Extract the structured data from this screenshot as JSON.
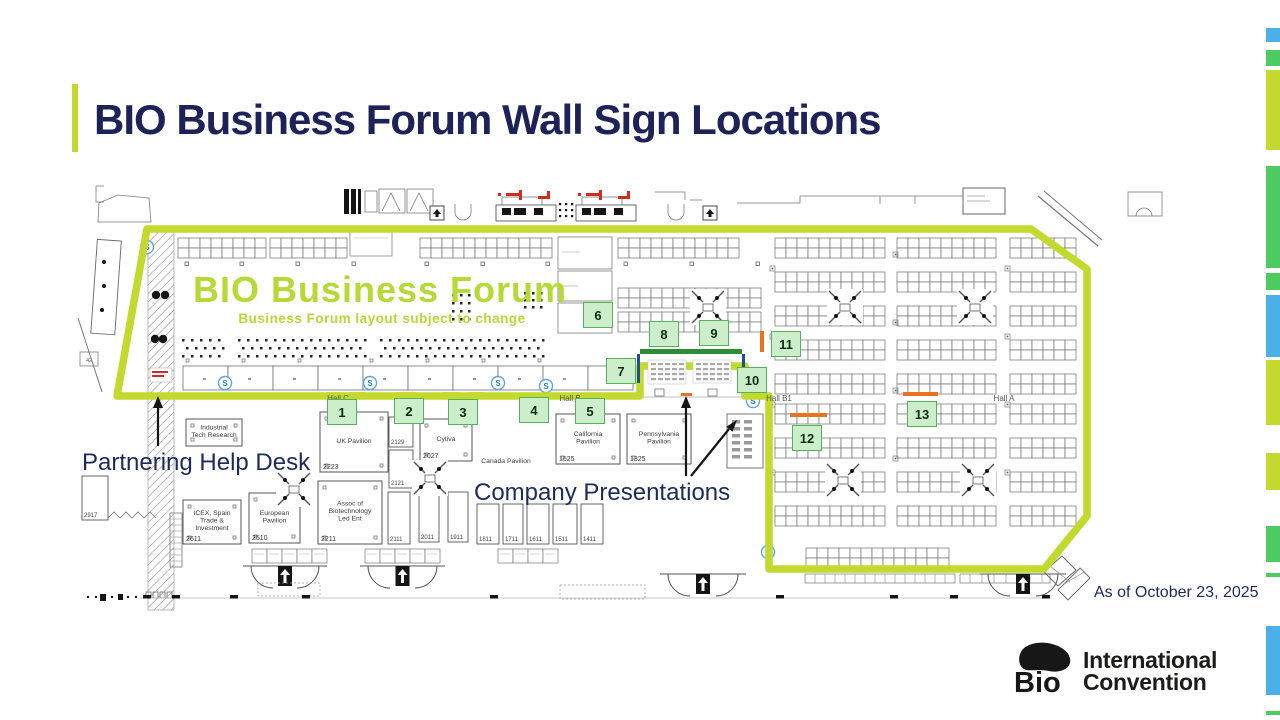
{
  "slide": {
    "title": "BIO Business Forum Wall Sign Locations",
    "as_of": "As of October 23, 2025"
  },
  "colors": {
    "chartreuse": "#c3d92d",
    "green": "#4dcb60",
    "blue": "#4cb0e8",
    "navy": "#1d2358",
    "label_navy": "#1d2a5e",
    "badge_fill": "#cdeeca",
    "badge_border": "#55b25b",
    "orange": "#e8721f",
    "red": "#d42a20",
    "yellow": "#e6e63c",
    "stage_green": "#2e8b36",
    "stage_blue": "#1d4f96",
    "forum_text": "#b5d935",
    "map_line": "#7a7a7a",
    "map_dark": "#141414"
  },
  "edge_bars": [
    {
      "color": "blue",
      "y": 28,
      "h": 14
    },
    {
      "color": "green",
      "y": 50,
      "h": 16
    },
    {
      "color": "chartreuse",
      "y": 70,
      "h": 80
    },
    {
      "color": "green",
      "y": 166,
      "h": 102
    },
    {
      "color": "green",
      "y": 273,
      "h": 17
    },
    {
      "color": "blue",
      "y": 295,
      "h": 62
    },
    {
      "color": "chartreuse",
      "y": 360,
      "h": 65
    },
    {
      "color": "chartreuse",
      "y": 453,
      "h": 37
    },
    {
      "color": "green",
      "y": 526,
      "h": 36
    },
    {
      "color": "green",
      "y": 573,
      "h": 4
    },
    {
      "color": "blue",
      "y": 626,
      "h": 69
    },
    {
      "color": "green",
      "y": 711,
      "h": 4
    }
  ],
  "floor_plan": {
    "forum_title": "BIO Business Forum",
    "forum_subtitle": "Business Forum layout subject to change",
    "s_marker": "S",
    "halls": [
      {
        "label": "Hall C",
        "x": 338,
        "y": 401
      },
      {
        "label": "Hall B",
        "x": 570,
        "y": 401
      },
      {
        "label": "Hall B1",
        "x": 779,
        "y": 401
      },
      {
        "label": "Hall A",
        "x": 1004,
        "y": 401
      }
    ],
    "pavilions": [
      {
        "name": "Industrial\nTech Research",
        "booth": "",
        "x": 186,
        "y": 419,
        "w": 56,
        "h": 27
      },
      {
        "name": "UK Pavilion",
        "booth": "2223",
        "x": 320,
        "y": 412,
        "w": 68,
        "h": 60
      },
      {
        "name": "Cytiva",
        "booth": "2027",
        "x": 420,
        "y": 419,
        "w": 52,
        "h": 42
      },
      {
        "name": "California\nPavilion",
        "booth": "1525",
        "x": 556,
        "y": 414,
        "w": 64,
        "h": 50
      },
      {
        "name": "Pennsylvania\nPavilion",
        "booth": "1325",
        "x": 627,
        "y": 414,
        "w": 64,
        "h": 50
      },
      {
        "name": "ICEX, Spain\nTrade &\nInvestment",
        "booth": "2611",
        "x": 183,
        "y": 500,
        "w": 58,
        "h": 44
      },
      {
        "name": "European\nPavilion",
        "booth": "2510",
        "x": 249,
        "y": 493,
        "w": 51,
        "h": 50
      },
      {
        "name": "Assoc of\nBiotechnology\nLed Ent",
        "booth": "2211",
        "x": 318,
        "y": 481,
        "w": 64,
        "h": 63
      }
    ],
    "area_labels": [
      {
        "label": "Canada Pavilion",
        "x": 506,
        "y": 463
      }
    ],
    "small_booths": [
      {
        "booth": "2129",
        "x": 389,
        "y": 417,
        "w": 24,
        "h": 30
      },
      {
        "booth": "2121",
        "x": 389,
        "y": 450,
        "w": 24,
        "h": 38
      },
      {
        "booth": "2111",
        "x": 388,
        "y": 492,
        "w": 22,
        "h": 52
      },
      {
        "booth": "2011",
        "x": 419,
        "y": 492,
        "w": 20,
        "h": 50
      },
      {
        "booth": "1911",
        "x": 448,
        "y": 492,
        "w": 20,
        "h": 50
      },
      {
        "booth": "1811",
        "x": 477,
        "y": 504,
        "w": 22,
        "h": 40
      },
      {
        "booth": "1711",
        "x": 503,
        "y": 504,
        "w": 20,
        "h": 40
      },
      {
        "booth": "1611",
        "x": 527,
        "y": 504,
        "w": 22,
        "h": 40
      },
      {
        "booth": "1511",
        "x": 553,
        "y": 504,
        "w": 24,
        "h": 40
      },
      {
        "booth": "1411",
        "x": 581,
        "y": 504,
        "w": 22,
        "h": 40
      },
      {
        "booth": "2917",
        "x": 82,
        "y": 476,
        "w": 26,
        "h": 44
      }
    ],
    "wall_signs": [
      {
        "num": "1",
        "cx": 342,
        "cy": 412
      },
      {
        "num": "2",
        "cx": 409,
        "cy": 411
      },
      {
        "num": "3",
        "cx": 463,
        "cy": 412
      },
      {
        "num": "4",
        "cx": 534,
        "cy": 410
      },
      {
        "num": "5",
        "cx": 590,
        "cy": 411
      },
      {
        "num": "6",
        "cx": 598,
        "cy": 315
      },
      {
        "num": "7",
        "cx": 621,
        "cy": 371
      },
      {
        "num": "8",
        "cx": 664,
        "cy": 334
      },
      {
        "num": "9",
        "cx": 714,
        "cy": 333
      },
      {
        "num": "10",
        "cx": 752,
        "cy": 380
      },
      {
        "num": "11",
        "cx": 786,
        "cy": 344
      },
      {
        "num": "12",
        "cx": 807,
        "cy": 438
      },
      {
        "num": "13",
        "cx": 922,
        "cy": 414
      }
    ],
    "annotations": [
      {
        "label": "Partnering Help Desk"
      },
      {
        "label": "Company Presentations"
      }
    ]
  },
  "logo": {
    "mark": "Bio",
    "line1": "International",
    "line2": "Convention"
  }
}
